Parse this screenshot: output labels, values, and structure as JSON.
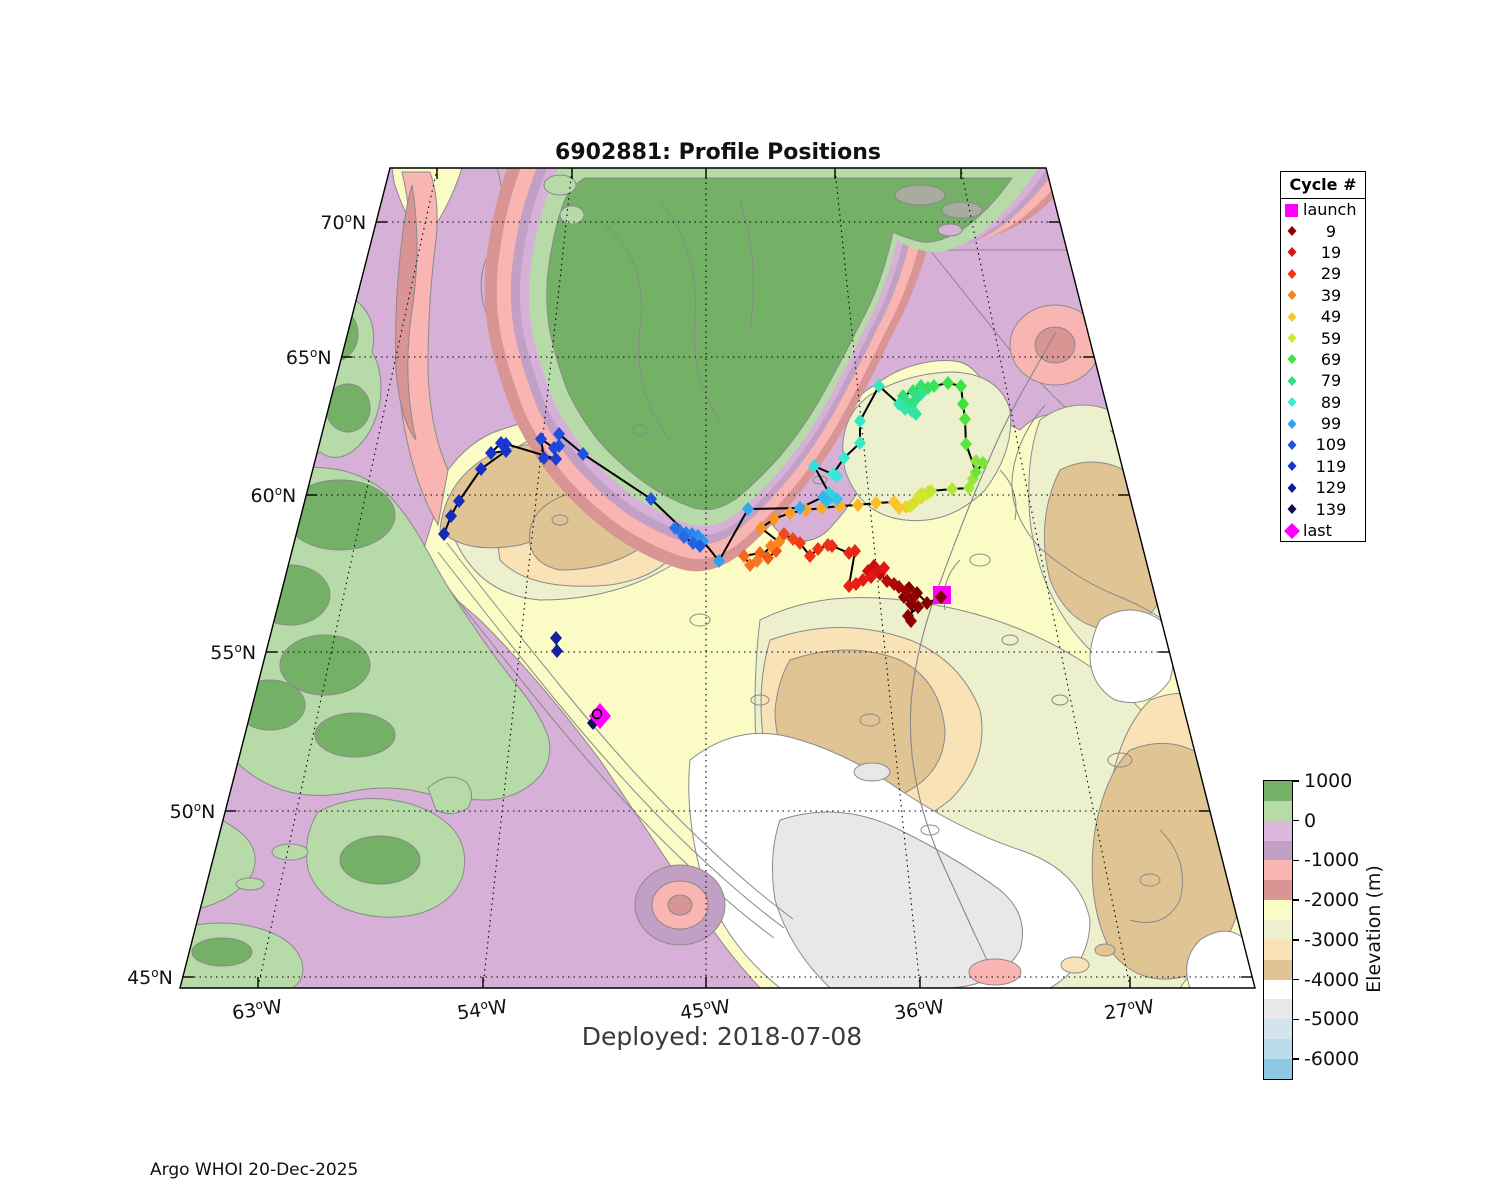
{
  "title": "6902881: Profile Positions",
  "deployed_label": "Deployed: 2018-07-08",
  "footer": "Argo WHOI 20-Dec-2025",
  "legend": {
    "title": "Cycle #",
    "entries": [
      {
        "label": "launch",
        "color": "#ff00ff",
        "shape": "square"
      },
      {
        "label": "9",
        "color": "#8c0000",
        "shape": "diamond"
      },
      {
        "label": "19",
        "color": "#e01414",
        "shape": "diamond"
      },
      {
        "label": "29",
        "color": "#f03414",
        "shape": "diamond"
      },
      {
        "label": "39",
        "color": "#f8821e",
        "shape": "diamond"
      },
      {
        "label": "49",
        "color": "#fcc32a",
        "shape": "diamond"
      },
      {
        "label": "59",
        "color": "#cdea32",
        "shape": "diamond"
      },
      {
        "label": "69",
        "color": "#3fe23c",
        "shape": "diamond"
      },
      {
        "label": "79",
        "color": "#2ee08c",
        "shape": "diamond"
      },
      {
        "label": "89",
        "color": "#38ecd8",
        "shape": "diamond"
      },
      {
        "label": "99",
        "color": "#2f9ff0",
        "shape": "diamond"
      },
      {
        "label": "109",
        "color": "#1f55e0",
        "shape": "diamond"
      },
      {
        "label": "119",
        "color": "#1734d0",
        "shape": "diamond"
      },
      {
        "label": "129",
        "color": "#101e96",
        "shape": "diamond"
      },
      {
        "label": "139",
        "color": "#0c1248",
        "shape": "diamond"
      },
      {
        "label": "last",
        "color": "#ff00ff",
        "shape": "diamond-large"
      }
    ]
  },
  "colorbar": {
    "label": "Elevation (m)",
    "tick_labels": [
      "1000",
      "0",
      "-1000",
      "-2000",
      "-3000",
      "-4000",
      "-5000",
      "-6000"
    ],
    "band_colors": [
      "#74b166",
      "#b6daa8",
      "#ddb7dd",
      "#c29fc4",
      "#f9b5b1",
      "#d99494",
      "#fbfbc6",
      "#edf0cd",
      "#f8e2b6",
      "#e0c493",
      "#ffffff",
      "#e8e8e8",
      "#d4e4ee",
      "#badbe9",
      "#8ec8e2"
    ]
  },
  "axes": {
    "lat": [
      [
        "70",
        "N"
      ],
      [
        "65",
        "N"
      ],
      [
        "60",
        "N"
      ],
      [
        "55",
        "N"
      ],
      [
        "50",
        "N"
      ],
      [
        "45",
        "N"
      ]
    ],
    "lon": [
      [
        "63",
        "W"
      ],
      [
        "54",
        "W"
      ],
      [
        "45",
        "W"
      ],
      [
        "36",
        "W"
      ],
      [
        "27",
        "W"
      ]
    ]
  },
  "map": {
    "accent_trajectory_color": "#000000",
    "launch": {
      "x": 942,
      "y": 595
    },
    "last": {
      "x": 600,
      "y": 716
    },
    "color_stops": [
      [
        1,
        "#7f0000"
      ],
      [
        9,
        "#8c0000"
      ],
      [
        19,
        "#e01414"
      ],
      [
        29,
        "#f03414"
      ],
      [
        39,
        "#f8821e"
      ],
      [
        49,
        "#fcc32a"
      ],
      [
        59,
        "#cdea32"
      ],
      [
        69,
        "#3fe23c"
      ],
      [
        79,
        "#2ee08c"
      ],
      [
        89,
        "#38ecd8"
      ],
      [
        99,
        "#2f9ff0"
      ],
      [
        109,
        "#1f55e0"
      ],
      [
        119,
        "#1734d0"
      ],
      [
        129,
        "#101e96"
      ],
      [
        141,
        "#0c1248"
      ]
    ],
    "paths": [
      {
        "points": [
          [
            941,
            597,
            1
          ],
          [
            927,
            603,
            2
          ],
          [
            917,
            593,
            3
          ],
          [
            909,
            588,
            4
          ],
          [
            904,
            597,
            5
          ],
          [
            911,
            604,
            6
          ],
          [
            918,
            607,
            7
          ],
          [
            908,
            616,
            8
          ],
          [
            911,
            621,
            9
          ],
          [
            913,
            598,
            10
          ],
          [
            906,
            591,
            11
          ],
          [
            899,
            587,
            12
          ],
          [
            894,
            584,
            13
          ],
          [
            887,
            581,
            14
          ],
          [
            880,
            574,
            15
          ],
          [
            874,
            566,
            16
          ],
          [
            868,
            571,
            17
          ],
          [
            877,
            571,
            18
          ],
          [
            884,
            568,
            19
          ],
          [
            871,
            577,
            20
          ],
          [
            863,
            580,
            21
          ],
          [
            856,
            584,
            22
          ],
          [
            849,
            586,
            23
          ],
          [
            855,
            551,
            24
          ],
          [
            849,
            553,
            25
          ],
          [
            832,
            546,
            26
          ],
          [
            828,
            545,
            27
          ],
          [
            818,
            549,
            28
          ],
          [
            810,
            556,
            29
          ],
          [
            800,
            543,
            30
          ],
          [
            793,
            539,
            31
          ],
          [
            784,
            534,
            32
          ],
          [
            776,
            551,
            33
          ],
          [
            768,
            558,
            34
          ],
          [
            760,
            553,
            35
          ],
          [
            744,
            556,
            36
          ],
          [
            750,
            565,
            37
          ],
          [
            757,
            561,
            38
          ],
          [
            771,
            546,
            39
          ],
          [
            779,
            542,
            40
          ],
          [
            761,
            528,
            41
          ],
          [
            774,
            519,
            42
          ],
          [
            790,
            513,
            43
          ],
          [
            806,
            510,
            44
          ],
          [
            822,
            508,
            45
          ],
          [
            840,
            506,
            46
          ],
          [
            858,
            505,
            47
          ],
          [
            876,
            503,
            48
          ],
          [
            894,
            502,
            49
          ],
          [
            899,
            508,
            50
          ],
          [
            906,
            507,
            51
          ],
          [
            913,
            504,
            52
          ],
          [
            921,
            498,
            53
          ],
          [
            928,
            492,
            54
          ],
          [
            922,
            494,
            55
          ],
          [
            916,
            501,
            56
          ],
          [
            910,
            506,
            57
          ],
          [
            919,
            496,
            58
          ],
          [
            927,
            494,
            59
          ],
          [
            931,
            491,
            60
          ],
          [
            952,
            489,
            61
          ],
          [
            969,
            488,
            62
          ],
          [
            973,
            479,
            63
          ],
          [
            976,
            461,
            64
          ],
          [
            983,
            463,
            65
          ],
          [
            976,
            472,
            66
          ],
          [
            966,
            444,
            67
          ],
          [
            965,
            419,
            68
          ],
          [
            963,
            404,
            69
          ],
          [
            961,
            386,
            70
          ],
          [
            948,
            383,
            71
          ],
          [
            934,
            386,
            72
          ],
          [
            928,
            388,
            73
          ],
          [
            921,
            386,
            74
          ],
          [
            913,
            391,
            75
          ],
          [
            903,
            396,
            76
          ],
          [
            906,
            401,
            77
          ],
          [
            911,
            406,
            78
          ],
          [
            916,
            399,
            79
          ],
          [
            921,
            394,
            80
          ],
          [
            912,
            411,
            81
          ],
          [
            916,
            414,
            82
          ],
          [
            905,
            409,
            83
          ],
          [
            899,
            404,
            84
          ],
          [
            879,
            386,
            85
          ],
          [
            860,
            421,
            86
          ],
          [
            860,
            443,
            87
          ],
          [
            844,
            458,
            88
          ],
          [
            833,
            474,
            89
          ],
          [
            837,
            476,
            90
          ],
          [
            814,
            466,
            91
          ],
          [
            829,
            493,
            92
          ],
          [
            833,
            497,
            93
          ],
          [
            837,
            499,
            94
          ],
          [
            827,
            501,
            95
          ],
          [
            823,
            497,
            96
          ],
          [
            800,
            508,
            97
          ],
          [
            748,
            509,
            98
          ],
          [
            719,
            561,
            99
          ],
          [
            703,
            541,
            100
          ],
          [
            698,
            536,
            101
          ],
          [
            692,
            534,
            102
          ],
          [
            686,
            533,
            103
          ],
          [
            680,
            531,
            104
          ],
          [
            675,
            528,
            105
          ],
          [
            684,
            537,
            106
          ],
          [
            693,
            543,
            107
          ],
          [
            700,
            546,
            108
          ],
          [
            651,
            499,
            109
          ],
          [
            583,
            454,
            110
          ],
          [
            559,
            434,
            111
          ],
          [
            559,
            446,
            112
          ],
          [
            554,
            448,
            113
          ],
          [
            541,
            439,
            114
          ],
          [
            544,
            458,
            115
          ],
          [
            556,
            459,
            116
          ],
          [
            506,
            444,
            117
          ],
          [
            501,
            443,
            118
          ],
          [
            491,
            453,
            119
          ],
          [
            506,
            451,
            120
          ],
          [
            481,
            469,
            121
          ],
          [
            459,
            501,
            122
          ],
          [
            451,
            516,
            123
          ],
          [
            444,
            534,
            124
          ]
        ],
        "link_launch": true
      },
      {
        "points": [
          [
            556,
            638,
            127
          ],
          [
            557,
            651,
            128
          ]
        ],
        "link_launch": false
      },
      {
        "points": [
          [
            593,
            723,
            139
          ]
        ],
        "link_last": true
      }
    ]
  }
}
